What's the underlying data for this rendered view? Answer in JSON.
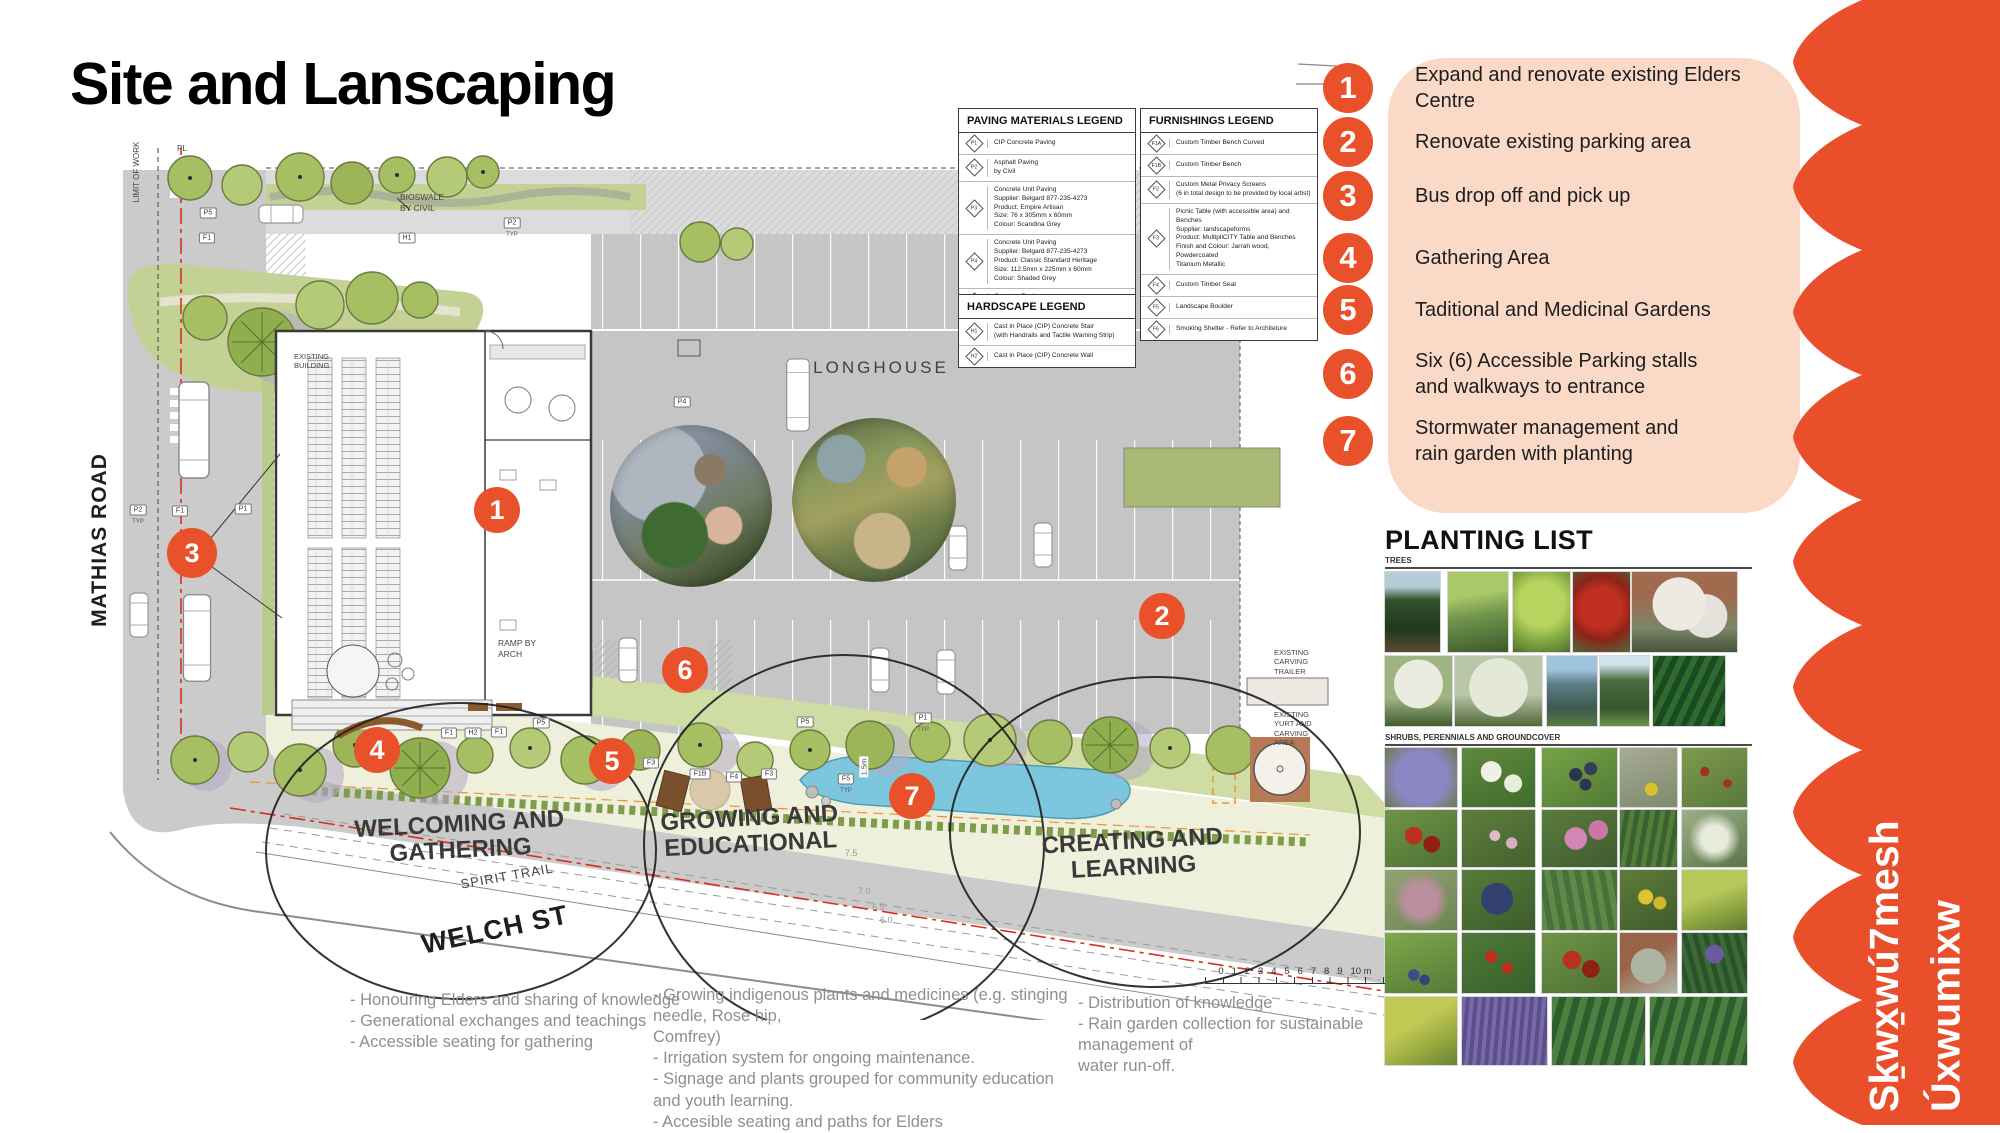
{
  "title": "Site and Lanscaping",
  "colors": {
    "accent_orange": "#E8512A",
    "peach_panel": "#FAD9C7",
    "band_red": "#EA4F2C",
    "water_blue": "#7CC7DE"
  },
  "key_items": [
    {
      "num": "1",
      "text": "Expand and renovate existing Elders Centre"
    },
    {
      "num": "2",
      "text": "Renovate existing parking area"
    },
    {
      "num": "3",
      "text": "Bus drop off and pick up"
    },
    {
      "num": "4",
      "text": "Gathering Area"
    },
    {
      "num": "5",
      "text": "Taditional and Medicinal Gardens"
    },
    {
      "num": "6",
      "text": "Six (6) Accessible Parking stalls and walkways to entrance"
    },
    {
      "num": "7",
      "text": "Stormwater management and rain garden with planting"
    }
  ],
  "legends": {
    "paving": {
      "title": "PAVING MATERIALS LEGEND",
      "rows": [
        {
          "code": "P1",
          "desc": "CIP Concrete Paving"
        },
        {
          "code": "P2",
          "desc": "Asphalt Paving\nby Civil"
        },
        {
          "code": "P3",
          "desc": "Concrete Unit Paving\nSupplier: Belgard 877-235-4273\nProduct: Empire Artisan\nSize: 76 x 305mm x 60mm\nColour: Scandina Grey"
        },
        {
          "code": "P4",
          "desc": "Concrete Unit Paving\nSupplier: Belgard 877-235-4273\nProduct: Classic Standard Heritage\nSize: 112.5mm x 225mm x 60mm\nColour: Shaded Grey"
        },
        {
          "code": "P5",
          "desc": "Granular Paving\n(with binder - ADA compliant)"
        }
      ]
    },
    "furnishings": {
      "title": "FURNISHINGS LEGEND",
      "rows": [
        {
          "code": "F1A",
          "desc": "Custom Timber Bench Curved"
        },
        {
          "code": "F1B",
          "desc": "Custom Timber Bench"
        },
        {
          "code": "F2",
          "desc": "Custom Metal Privacy Screens\n(6 in total design to be provided by local artist)"
        },
        {
          "code": "F3",
          "desc": "Picnic Table (with accessible area) and Benches\nSupplier: landscapeforms\nProduct: MultipliCITY Table and Benches\nFinish and Colour: Jarrah wood, Powdercoated\nTitanium Metallic"
        },
        {
          "code": "F4",
          "desc": "Custom Timber Seat"
        },
        {
          "code": "F5",
          "desc": "Landscape Boulder"
        },
        {
          "code": "F6",
          "desc": "Smoking Shelter - Refer to Architeture"
        }
      ]
    },
    "hardscape": {
      "title": "HARDSCAPE LEGEND",
      "rows": [
        {
          "code": "H1",
          "desc": "Cast in Place (CIP) Concrete Stair\n(with Handrails and Tactile Warning Strip)"
        },
        {
          "code": "H2",
          "desc": "Cast in Place (CIP) Concrete Wall"
        }
      ]
    }
  },
  "plan": {
    "street_left": "MATHIAS ROAD",
    "street_bottom": "WELCH ST",
    "trail": "SPIRIT TRAIL",
    "longhouse": "LONGHOUSE",
    "zones": [
      "WELCOMING AND\nGATHERING",
      "GROWING AND\nEDUCATIONAL",
      "CREATING AND\nLEARNING"
    ],
    "annotations": {
      "limit_of_work": "LIMIT OF WORK",
      "pl": "PL",
      "bioswale": "BIOSWALE\nBY CIVIL",
      "ramp": "RAMP BY\nARCH",
      "existing": "EXISTING\nBUILDING",
      "carving_trailer": "EXISTING\nCARVING\nTRAILER",
      "yurt": "EXISTING\nYURT AND\nCARVING\nAREA",
      "depth_label": "1.5m",
      "typ": "TYP"
    },
    "contours": [
      "7.5",
      "7.0",
      "6.5",
      "6.0"
    ],
    "scale_bar": "0   1   2   3   4   5   6   7   8   9   10 m",
    "callouts": [
      "1",
      "2",
      "3",
      "4",
      "5",
      "6",
      "7"
    ],
    "markers": [
      "P5",
      "F1",
      "H1",
      "P2",
      "P2",
      "F1",
      "P1",
      "P4",
      "F1",
      "H2",
      "F1",
      "P5",
      "F3",
      "F1B",
      "F4",
      "F3",
      "P5",
      "F5",
      "P1"
    ]
  },
  "planting": {
    "title": "PLANTING LIST",
    "sections": [
      {
        "label": "TREES"
      },
      {
        "label": "SHRUBS, PERENNIALS AND GROUNDCOVER"
      }
    ],
    "tree_photos": [
      "spruce-conifer",
      "broadleaf-grove",
      "green-maple",
      "red-maple",
      "white-flowering-street-tree",
      "white-dogwood",
      "white-flowering-shrub-tree",
      "blue-spruce",
      "spruce",
      "sword-ferns"
    ],
    "shrub_photos": [
      "purple-blue-flower-mound",
      "white-flower-evergreen",
      "dark-berry-branch",
      "silver-foliage-yellow-flower",
      "red-flower-meadow",
      "red-berries",
      "pink-flower-shrub",
      "pink-wild-rose",
      "willow-shrub",
      "white-flower-mass",
      "pink-spirea",
      "blue-berry-cluster",
      "green-groundcover",
      "yellow-flower-shrub",
      "golden-green-shrub",
      "blueberries",
      "red-flower-groundcover",
      "red-berry-groundcover",
      "silver-mound",
      "purple-liriope",
      "golden-groundcover",
      "lavender",
      "sword-fern",
      "fern-grove"
    ]
  },
  "footer_notes": {
    "col1": "- Honouring Elders and sharing of knowledge\n- Generational exchanges and teachings\n- Accessible seating for gathering",
    "col2": "- Growing indigenous plants and medicines (e.g. stinging needle, Rose hip,\nComfrey)\n- Irrigation system for ongoing maintenance.\n- Signage and plants grouped for community education and youth learning.\n- Accesible seating and paths for Elders",
    "col3": "- Distribution of knowledge\n- Rain garden collection for sustainable management of\nwater run-off."
  },
  "brand": {
    "line1": "Sḵwx̱wú7mesh",
    "line2": "Úxwumixw"
  }
}
